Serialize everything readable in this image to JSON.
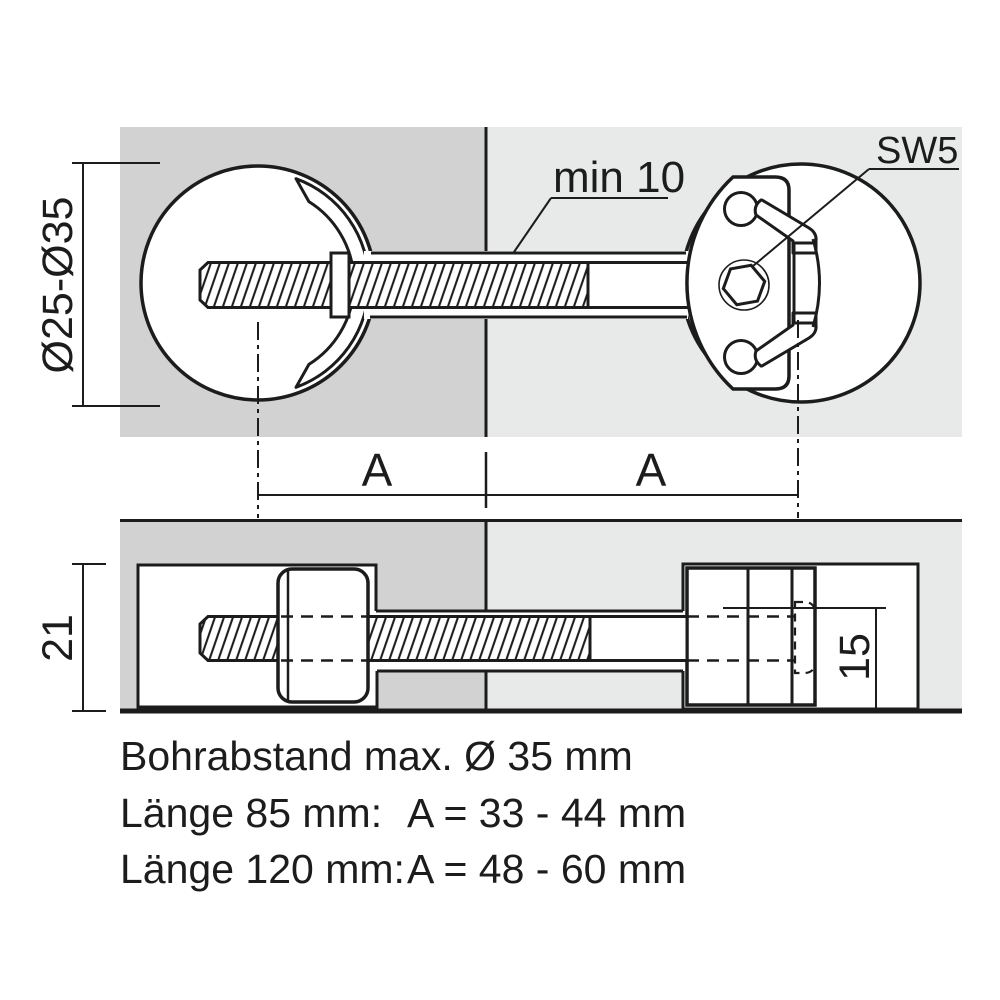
{
  "title": "Worktop connector technical drawing",
  "colors": {
    "panel_left": "#d2d2d2",
    "panel_right": "#e8e9e9",
    "line": "#1c1c1c",
    "background": "#ffffff"
  },
  "top_view": {
    "diameter_dimension": "Ø25-Ø35",
    "min_clearance_label": "min 10",
    "wrench_size_label": "SW5",
    "span_dimension_left": "A",
    "span_dimension_right": "A"
  },
  "bottom_view": {
    "depth_dimension": "21",
    "height_dimension": "15"
  },
  "notes": {
    "line1": "Bohrabstand max. Ø 35 mm",
    "line2_label": "Länge 85 mm:",
    "line2_value": "A = 33 - 44 mm",
    "line3_label": "Länge 120 mm:",
    "line3_value": "A = 48 - 60 mm"
  }
}
